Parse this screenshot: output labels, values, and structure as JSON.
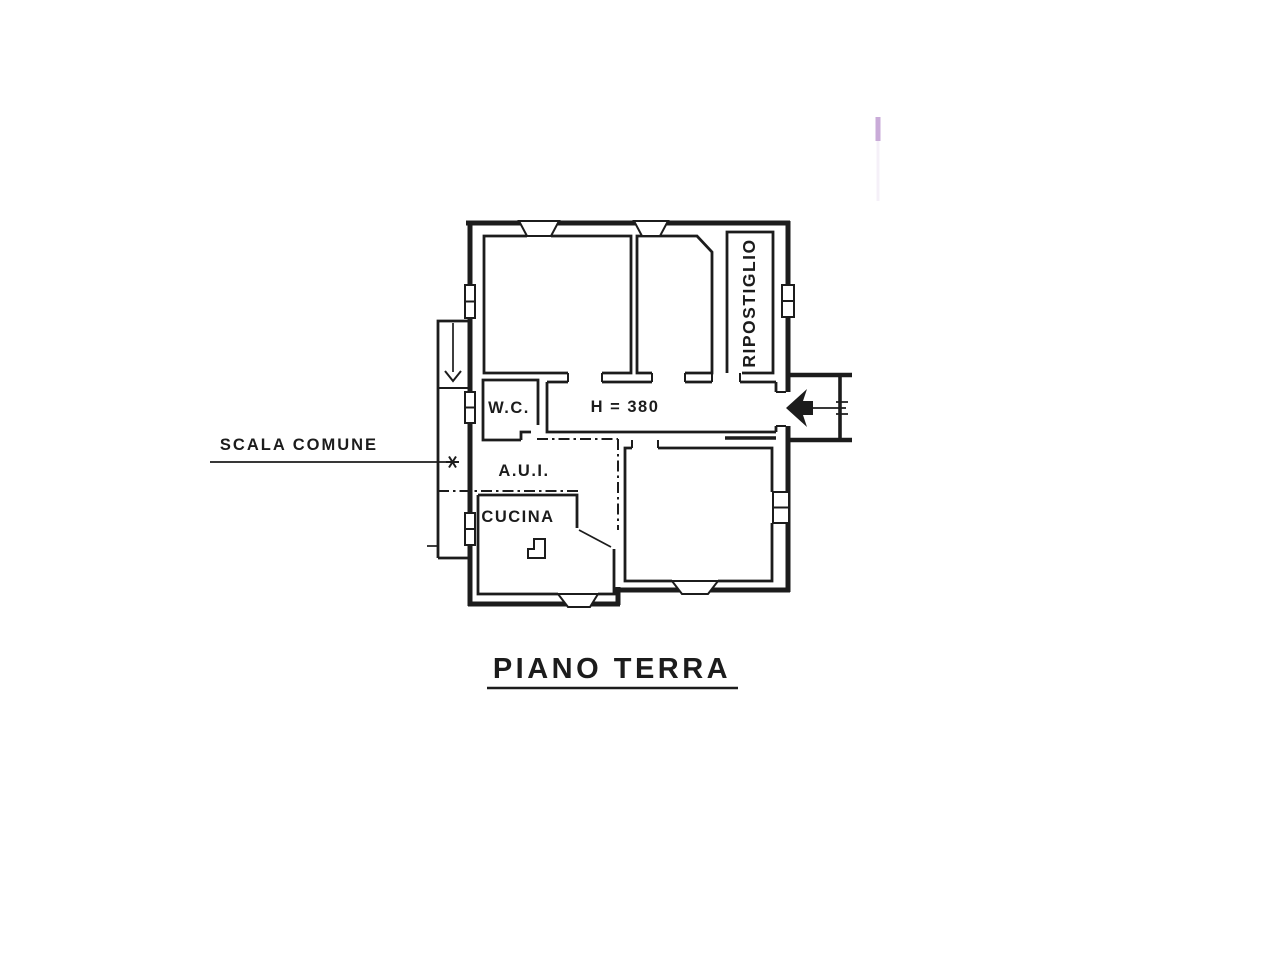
{
  "plan": {
    "title": "PIANO TERRA",
    "labels": {
      "scala_comune": "SCALA COMUNE",
      "wc": "W.C.",
      "corridor_height": "H = 380",
      "aui": "A.U.I.",
      "cucina": "CUCINA",
      "ripostiglio": "RIPOSTIGLIO"
    },
    "colors": {
      "ink": "#1c1c1c",
      "paper": "#ffffff",
      "artifact": "#c9abd8"
    }
  }
}
